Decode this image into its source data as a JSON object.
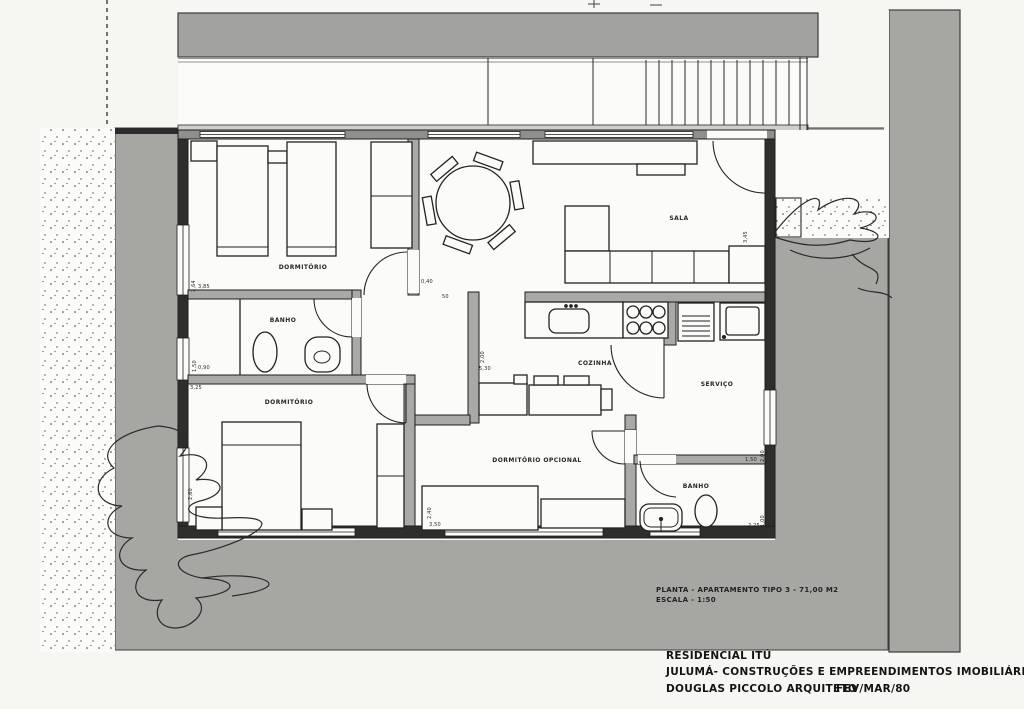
{
  "caption": {
    "line1": "PLANTA - APARTAMENTO  TIPO 3 -   71,00 M2",
    "line2": "ESCALA - 1:50"
  },
  "title_block": {
    "project": "RESIDENCIAL  ITÚ",
    "company": "JULUMÁ- CONSTRUÇÕES E EMPREENDIMENTOS  IMOBILIÁRIOS  LTDA.",
    "architect": "DOUGLAS PICCOLO  ARQUITETO",
    "date": "FEV/MAR/80"
  },
  "rooms": {
    "bedroom1": "DORMITÓRIO",
    "bath1": "BANHO",
    "bedroom2": "DORMITÓRIO",
    "living": "SALA",
    "kitchen": "COZINHA",
    "service": "SERVIÇO",
    "optional_bedroom": "DORMITÓRIO OPCIONAL",
    "bath2": "BANHO"
  },
  "dims": {
    "d1": "2,64",
    "d2": "3,85",
    "d3": "1,50",
    "d4": "0,90",
    "d5": "3,25",
    "d6": "2,60",
    "d7": "0,40",
    "d8": "50",
    "d9": "2,00",
    "d10": "5,30",
    "d11": "3,45",
    "d12": "1,50",
    "d13": "2,00",
    "d14": "2,25",
    "d15": "1,00",
    "d16": "2,40",
    "d17": "3,50"
  },
  "colors": {
    "paper": "#f6f6f3",
    "ground_gray": "#a6a6a3",
    "wall_dark": "#2e2e2c",
    "wall_gray": "#a9a9a6",
    "ink": "#1d1d1d"
  }
}
